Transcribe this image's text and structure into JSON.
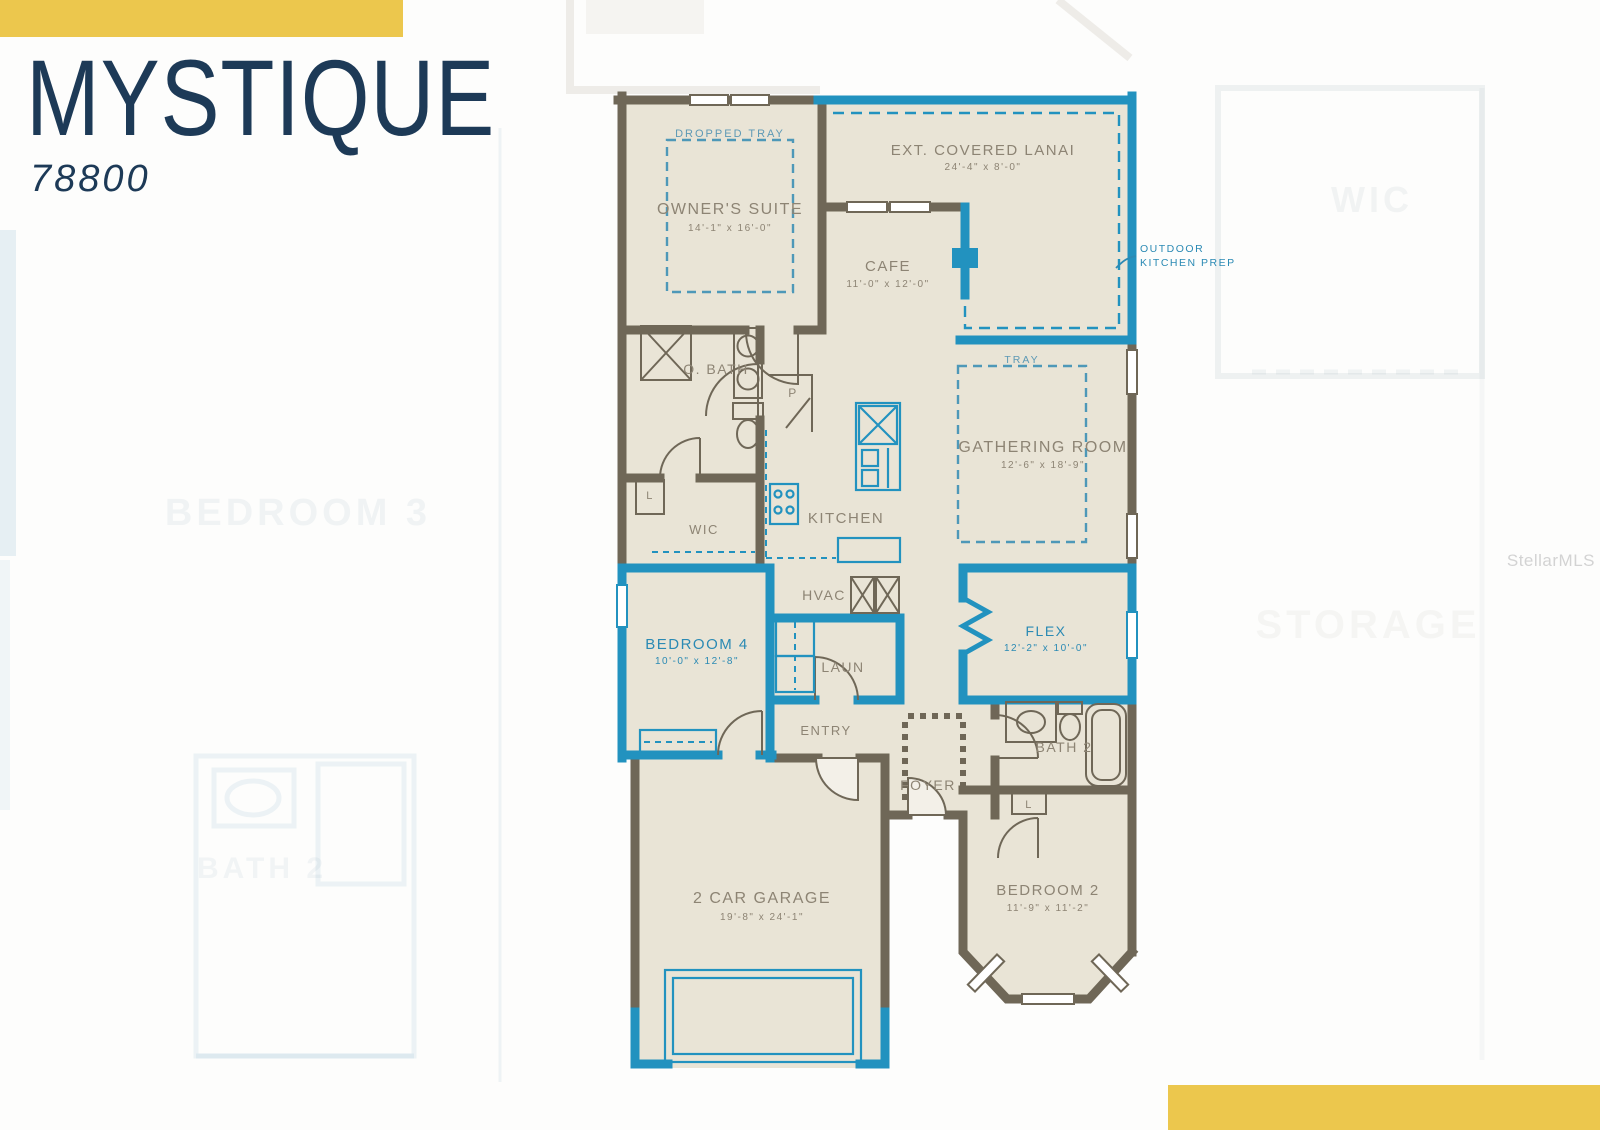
{
  "header": {
    "title": "MYSTIQUE",
    "model_number": "78800"
  },
  "watermark": {
    "text": "StellarMLS"
  },
  "colors": {
    "accent_yellow": "#ecc74d",
    "title_navy": "#1d3a57",
    "wall_brown": "#6f6757",
    "accent_blue": "#2292bf",
    "floor_beige": "#e9e4d6",
    "label_gray": "#8d8474"
  },
  "floorplan": {
    "rooms": {
      "owners_suite": {
        "name": "OWNER'S SUITE",
        "dims": "14'-1\" x 16'-0\""
      },
      "lanai": {
        "name": "EXT. COVERED LANAI",
        "dims": "24'-4\" x 8'-0\""
      },
      "cafe": {
        "name": "CAFE",
        "dims": "11'-0\" x 12'-0\""
      },
      "gathering": {
        "name": "GATHERING ROOM",
        "dims": "12'-6\" x 18'-9\""
      },
      "kitchen": {
        "name": "KITCHEN"
      },
      "o_bath": {
        "name": "O. BATH"
      },
      "pantry": {
        "name": "P"
      },
      "wic": {
        "name": "WIC"
      },
      "hvac": {
        "name": "HVAC"
      },
      "bedroom4": {
        "name": "BEDROOM 4",
        "dims": "10'-0\" x 12'-8\""
      },
      "laundry": {
        "name": "LAUN"
      },
      "flex": {
        "name": "FLEX",
        "dims": "12'-2\" x 10'-0\""
      },
      "entry": {
        "name": "ENTRY"
      },
      "foyer": {
        "name": "FOYER"
      },
      "bath2": {
        "name": "BATH 2"
      },
      "linen_owner": {
        "name": "L"
      },
      "linen_bath2": {
        "name": "L"
      },
      "bedroom2": {
        "name": "BEDROOM 2",
        "dims": "11'-9\" x 11'-2\""
      },
      "garage": {
        "name": "2 CAR GARAGE",
        "dims": "19'-8\" x 24'-1\""
      }
    },
    "annotations": {
      "dropped_tray": "DROPPED TRAY",
      "tray": "TRAY",
      "outdoor_prep_1": "OUTDOOR",
      "outdoor_prep_2": "KITCHEN PREP"
    },
    "background_labels": {
      "bedroom3": "BEDROOM 3",
      "storage": "STORAGE",
      "wic": "WIC",
      "bath2": "BATH 2"
    }
  }
}
